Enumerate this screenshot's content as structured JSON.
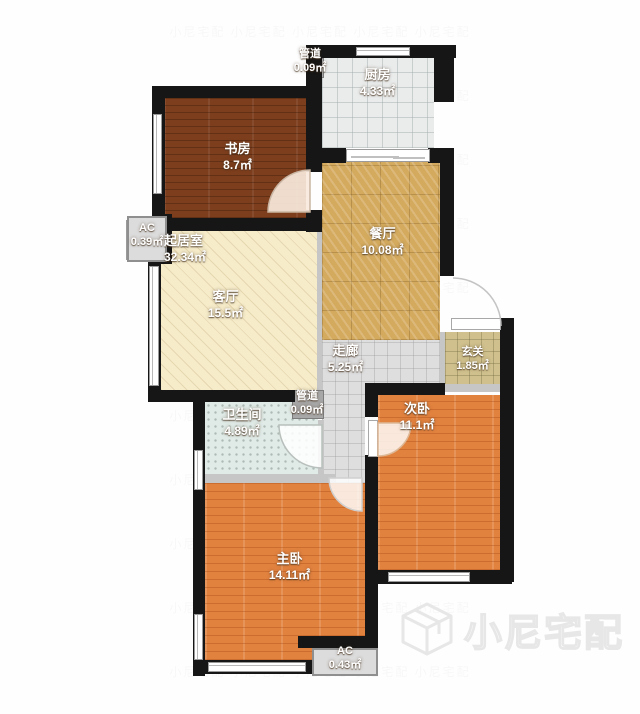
{
  "watermark": {
    "brand": "小尼宅配",
    "tile": "小尼宅配  小尼宅配  小尼宅配  小尼宅配  小尼宅配\n小尼宅配  小尼宅配  小尼宅配  小尼宅配  小尼宅配\n小尼宅配  小尼宅配  小尼宅配  小尼宅配  小尼宅配\n小尼宅配  小尼宅配  小尼宅配  小尼宅配  小尼宅配\n小尼宅配  小尼宅配  小尼宅配  小尼宅配  小尼宅配\n小尼宅配  小尼宅配  小尼宅配  小尼宅配  小尼宅配\n小尼宅配  小尼宅配  小尼宅配  小尼宅配  小尼宅配\n小尼宅配  小尼宅配  小尼宅配  小尼宅配  小尼宅配\n小尼宅配  小尼宅配  小尼宅配  小尼宅配  小尼宅配\n小尼宅配  小尼宅配  小尼宅配  小尼宅配  小尼宅配\n小尼宅配  小尼宅配  小尼宅配  小尼宅配  小尼宅配"
  },
  "rooms": {
    "study": {
      "name": "书房",
      "area": "8.7㎡"
    },
    "kitchen": {
      "name": "厨房",
      "area": "4.33㎡"
    },
    "duct_top": {
      "name": "管道",
      "area": "0.09㎡"
    },
    "living_total": {
      "name": "起居室",
      "area": "32.34㎡"
    },
    "living": {
      "name": "客厅",
      "area": "15.5㎡"
    },
    "dining": {
      "name": "餐厅",
      "area": "10.08㎡"
    },
    "corridor": {
      "name": "走廊",
      "area": "5.25㎡"
    },
    "entry": {
      "name": "玄关",
      "area": "1.85㎡"
    },
    "bath": {
      "name": "卫生间",
      "area": "4.89㎡"
    },
    "duct_mid": {
      "name": "管道",
      "area": "0.09㎡"
    },
    "bed_second": {
      "name": "次卧",
      "area": "11.1㎡"
    },
    "bed_master": {
      "name": "主卧",
      "area": "14.11㎡"
    },
    "ac_left": {
      "name": "AC",
      "area": "0.39㎡"
    },
    "ac_bottom": {
      "name": "AC",
      "area": "0.43㎡"
    }
  },
  "colors": {
    "wall": "#161616",
    "floor-study": "#7d3e1d",
    "floor-bedroom": "#e2823f",
    "floor-living": "#f6ecca",
    "floor-dining": "#d4aa5e",
    "floor-kitchen": "#eaecec",
    "floor-corridor": "#dededf",
    "floor-entry": "#cfc08d",
    "floor-bath": "#e0eae6",
    "ac-box": "#dcdcdc"
  }
}
